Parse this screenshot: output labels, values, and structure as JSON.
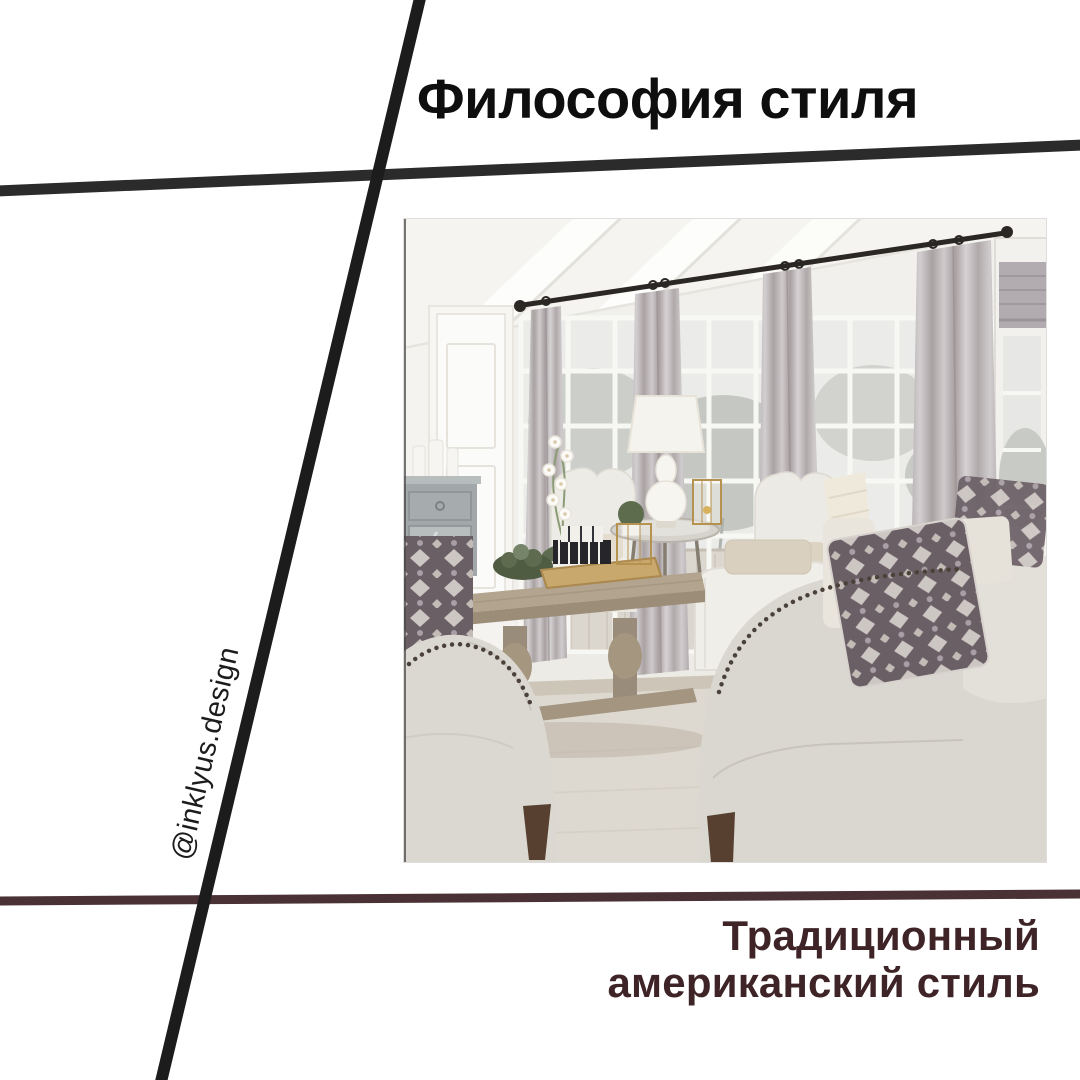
{
  "canvas": {
    "width": 1080,
    "height": 1080,
    "background": "#ffffff"
  },
  "title": {
    "text": "Философия стиля",
    "color": "#0e0e0e"
  },
  "watermark": {
    "text": "@inklyus.design",
    "color": "#1c1c1c"
  },
  "caption": {
    "lines": [
      "Традиционный",
      "американский стиль"
    ],
    "color": "#3f2427"
  },
  "decor_lines": {
    "steep_diagonal": {
      "color": "#1c1c1c"
    },
    "top_horizontal": {
      "color": "#2b2b2b"
    },
    "bottom_brown": {
      "color": "#4a3136"
    }
  },
  "photo": {
    "palette": {
      "wall": "#f1f0ec",
      "ceiling": "#f5f4f0",
      "curtain": "#b9b2b5",
      "window_outside": "#e9eae7",
      "sofa_fabric": "#dbd8d2",
      "wood_table": "#a3957f",
      "ikat_pillow": "#6b5f66",
      "wood_leg": "#57402f",
      "rug": "#ded9d0",
      "curtain_rod": "#2b2724"
    }
  }
}
